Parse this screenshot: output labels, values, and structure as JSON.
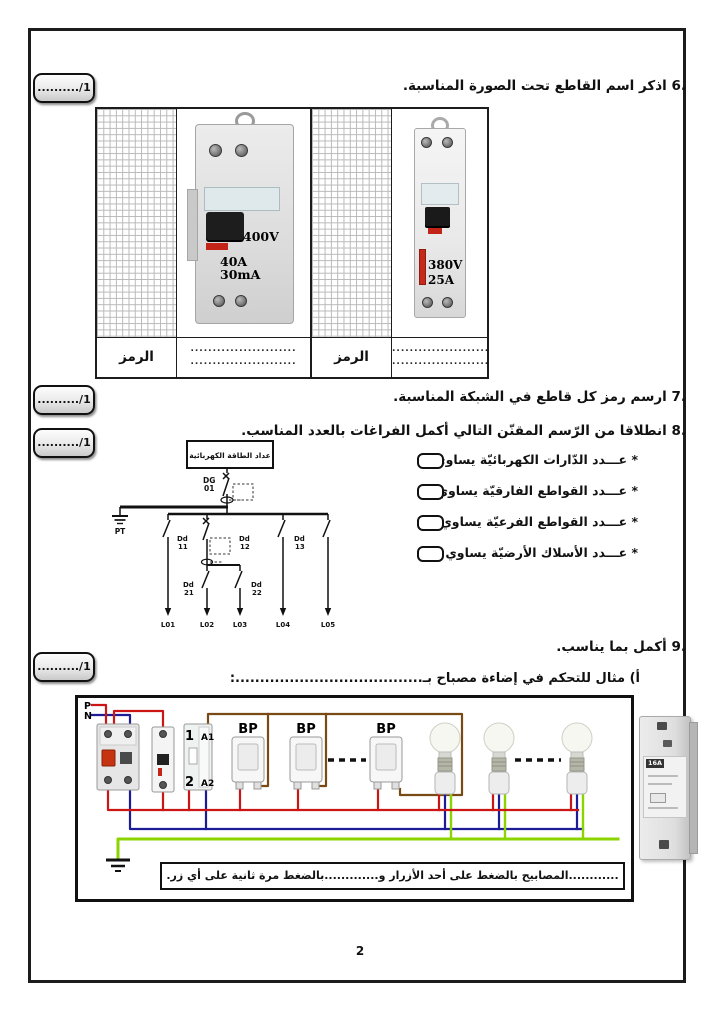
{
  "scores": {
    "label": "........../1"
  },
  "q6": {
    "number": "6.",
    "text": "اذكر اسم القاطع تحت الصورة المناسبة.",
    "symbol_label": "الرمز",
    "dots": "........................",
    "device_left": {
      "voltage": "400V",
      "current": "40A",
      "sensitivity": "30mA"
    },
    "device_right": {
      "voltage": "380V",
      "current": "25A"
    }
  },
  "q7": {
    "number": "7.",
    "text": "ارسم رمز كل قاطع في الشبكة المناسبة."
  },
  "q8": {
    "number": "8.",
    "text": "انطلاقا من الرّسم المقنّن التالي أكمل الفراغات بالعدد المناسب.",
    "bullets": [
      "* عـــدد الدّارات الكهربائيّة يساوي",
      "* عـــدد القواطع الفارقيّة يساوي",
      "* عـــدد القواطع الفرعيّة يساوي",
      "* عـــدد الأسلاك الأرضيّة يساوي"
    ],
    "diagram": {
      "meter": "عداد الطاقة الكهربائية",
      "dg": "DG",
      "dg_num": "01",
      "earth": "PT",
      "b11": "Dd",
      "b11n": "11",
      "b12": "Dd",
      "b12n": "12",
      "b13": "Dd",
      "b13n": "13",
      "b21": "Dd",
      "b21n": "21",
      "b22": "Dd",
      "b22n": "22",
      "l1": "L01",
      "l2": "L02",
      "l3": "L03",
      "l4": "L04",
      "l5": "L05"
    }
  },
  "q9": {
    "number": "9.",
    "text": "أكمل بما يناسب.",
    "sub_a": "أ)    مثال للتحكم في إضاءة مصباح بـ......................................:",
    "wiring": {
      "p": "P",
      "n": "N",
      "t1": "1",
      "ta1": "A1",
      "t2": "2",
      "ta2": "A2",
      "bp": "BP",
      "strip": "............المصابيح بالضغط على أحد الأزرار و.............بالضغط مرة ثانية على أي زر.",
      "module": "16A"
    }
  },
  "page": {
    "number": "2"
  }
}
